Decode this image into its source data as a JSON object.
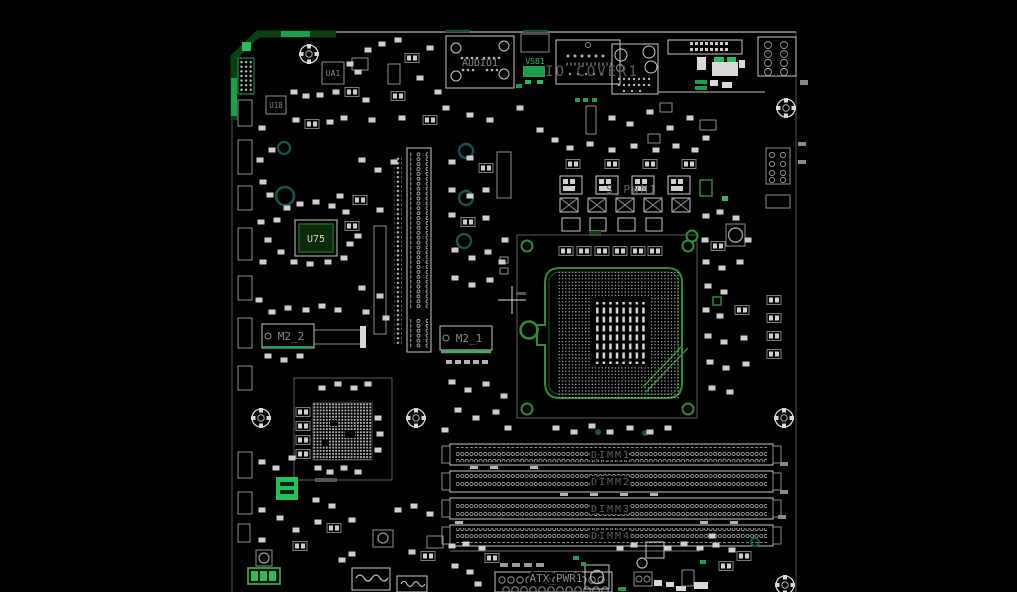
{
  "canvas": {
    "description": "PCB boardview of a micro-ATX motherboard, white silkscreen on black with green plane highlights"
  },
  "colors": {
    "background": "#000000",
    "silkscreen": "#d4d4d4",
    "dim_text": "#5f5f5f",
    "green_dark": "#0c3f14",
    "green_bright": "#27bf5a",
    "green_socket": "#2e8b3a",
    "teal": "#0e5a50"
  },
  "labels": {
    "audio_connector": "AUDIO1",
    "vsb_connector": "VSB1",
    "io_cover": "IO COVER1",
    "chip_ua1": "UA1",
    "chip_u18": "U18",
    "chip_u75": "U75",
    "m2_slot_2": "M2_2",
    "m2_slot_1": "M2_1",
    "vrm_pwm": "S_PWM1",
    "atx_power": "ATX_PWR1"
  },
  "dimm_slots": [
    "DIMM1",
    "DIMM2",
    "DIMM3",
    "DIMM4"
  ]
}
